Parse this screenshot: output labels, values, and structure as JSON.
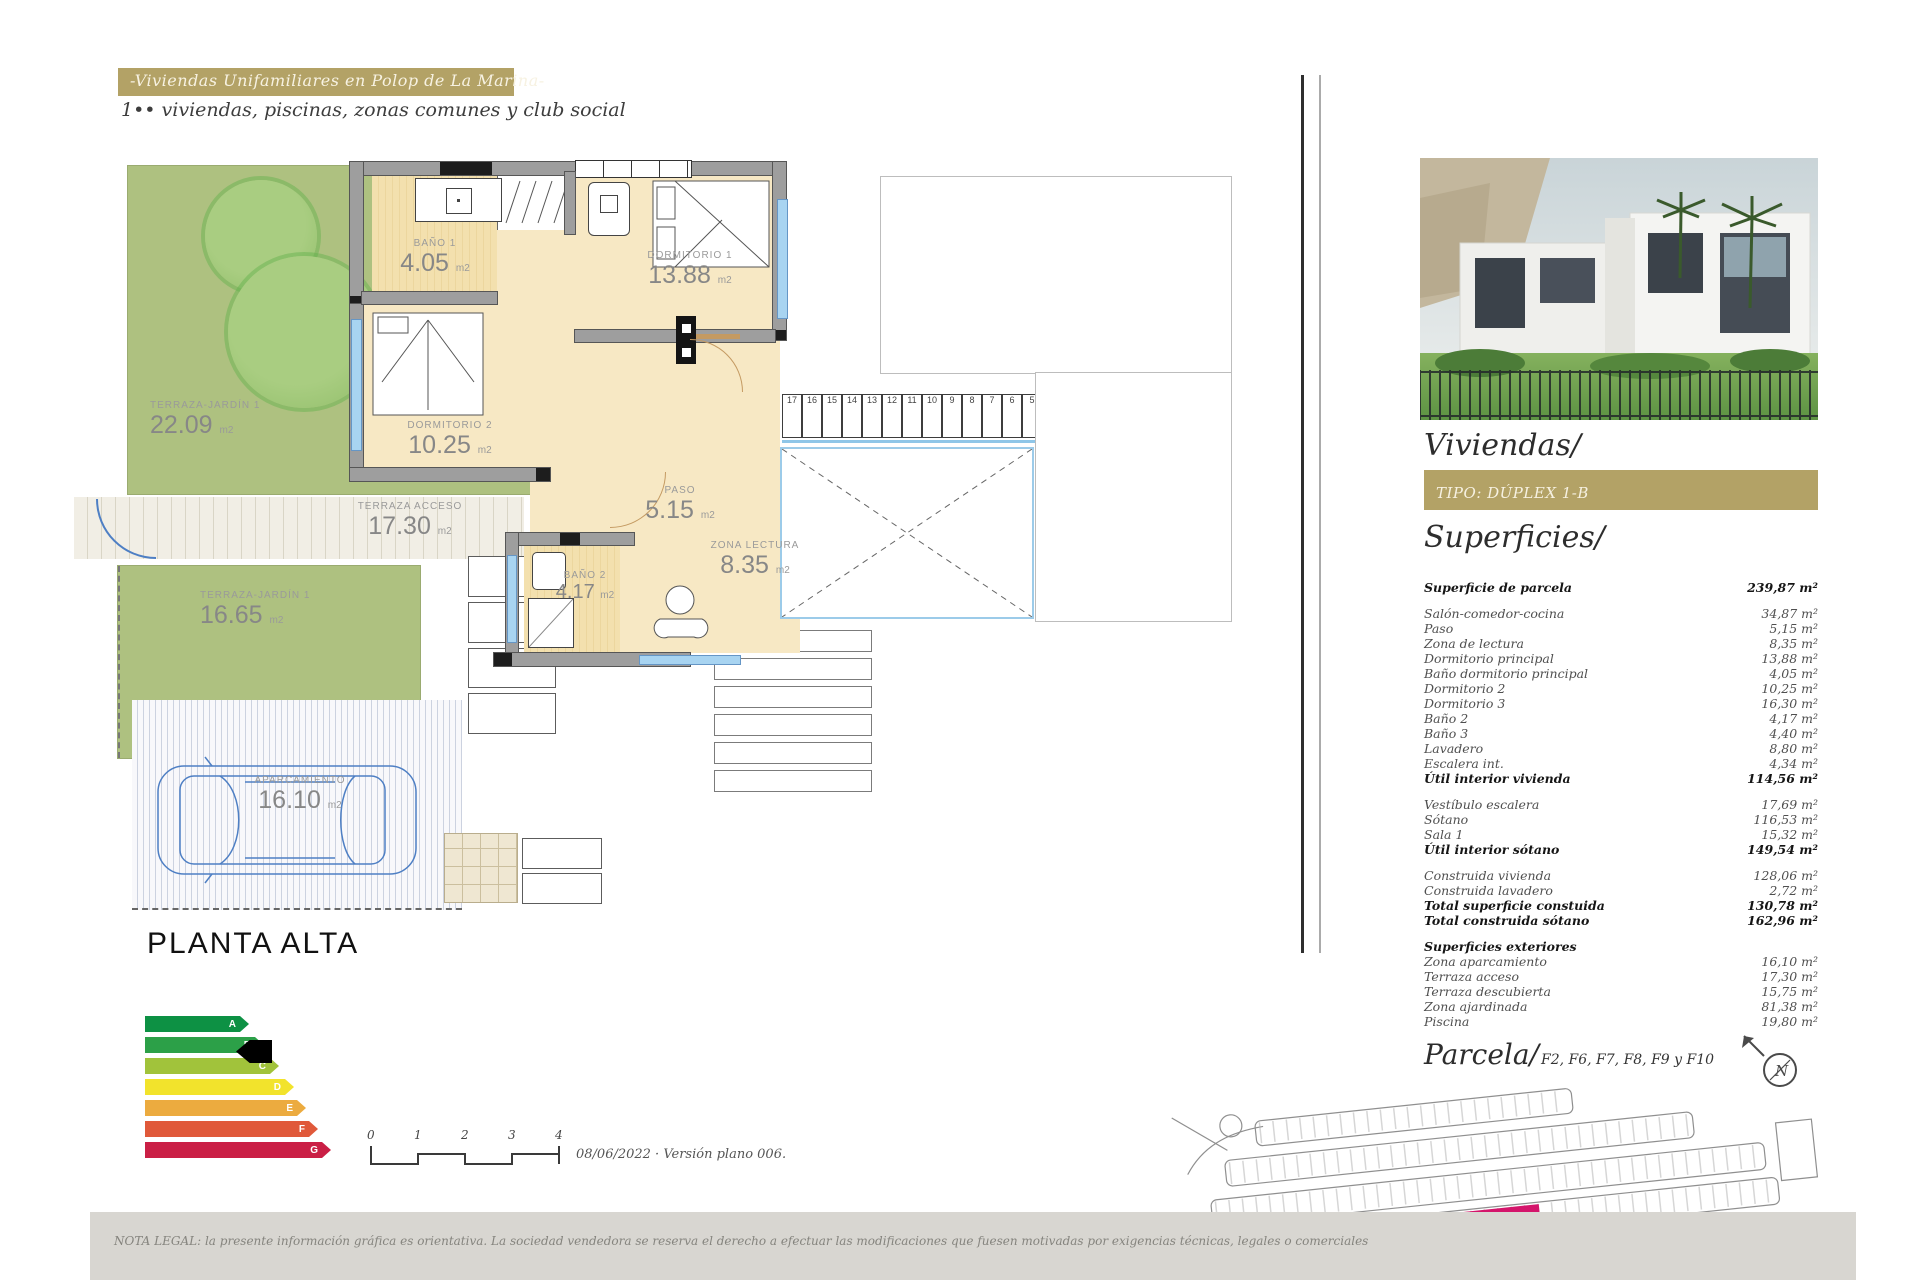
{
  "header": {
    "title": "-Viviendas Unifamiliares en Polop de La Marina-",
    "subtitle": "1•• viviendas, piscinas, zonas comunes y club social"
  },
  "plan": {
    "title": "PLANTA ALTA",
    "rooms": [
      {
        "name": "TERRAZA-JARDÍN 1",
        "area": "22.09",
        "unit": "m2"
      },
      {
        "name": "BAÑO 1",
        "area": "4.05",
        "unit": "m2"
      },
      {
        "name": "DORMITORIO 1",
        "area": "13.88",
        "unit": "m2"
      },
      {
        "name": "DORMITORIO 2",
        "area": "10.25",
        "unit": "m2"
      },
      {
        "name": "TERRAZA ACCESO",
        "area": "17.30",
        "unit": "m2"
      },
      {
        "name": "PASO",
        "area": "5.15",
        "unit": "m2"
      },
      {
        "name": "ZONA LECTURA",
        "area": "8.35",
        "unit": "m2"
      },
      {
        "name": "BAÑO 2",
        "area": "4.17",
        "unit": "m2"
      },
      {
        "name": "TERRAZA-JARDÍN 1",
        "area": "16.65",
        "unit": "m2"
      },
      {
        "name": "APARCAMIENTO",
        "area": "16.10",
        "unit": "m2"
      }
    ],
    "stair_numbers_run": [
      "17",
      "16",
      "15",
      "14",
      "13",
      "12",
      "11",
      "10",
      "9",
      "8",
      "7",
      "6",
      "5",
      "4"
    ],
    "stair_numbers_col": [
      "3",
      "2",
      "1"
    ],
    "scale_ticks": [
      "0",
      "1",
      "2",
      "3",
      "4"
    ],
    "scale_note": "08/06/2022 · Versión plano 006."
  },
  "energy": {
    "ratings": [
      {
        "label": "A",
        "color": "#0d9144"
      },
      {
        "label": "B",
        "color": "#2ca048"
      },
      {
        "label": "C",
        "color": "#a1c33b"
      },
      {
        "label": "D",
        "color": "#f2e32c"
      },
      {
        "label": "E",
        "color": "#ecab3f"
      },
      {
        "label": "F",
        "color": "#e0593a"
      },
      {
        "label": "G",
        "color": "#ca1f45"
      }
    ],
    "indicated_rating": "B"
  },
  "sidebar": {
    "viviendas_title": "Viviendas/",
    "tipo_label": "TIPO: DÚPLEX 1-B",
    "superficies_title": "Superficies/",
    "rows": [
      {
        "label": "Superficie de parcela",
        "value": "239,87 m²",
        "bold": true
      },
      {
        "spacer": true
      },
      {
        "label": "Salón-comedor-cocina",
        "value": "34,87 m²"
      },
      {
        "label": "Paso",
        "value": "5,15 m²"
      },
      {
        "label": "Zona de lectura",
        "value": "8,35 m²"
      },
      {
        "label": "Dormitorio principal",
        "value": "13,88 m²"
      },
      {
        "label": "Baño dormitorio principal",
        "value": "4,05 m²"
      },
      {
        "label": "Dormitorio 2",
        "value": "10,25 m²"
      },
      {
        "label": "Dormitorio 3",
        "value": "16,30 m²"
      },
      {
        "label": "Baño 2",
        "value": "4,17 m²"
      },
      {
        "label": "Baño 3",
        "value": "4,40 m²"
      },
      {
        "label": "Lavadero",
        "value": "8,80 m²"
      },
      {
        "label": "Escalera int.",
        "value": "4,34 m²"
      },
      {
        "label": "Útil interior vivienda",
        "value": "114,56 m²",
        "bold": true
      },
      {
        "spacer": true
      },
      {
        "label": "Vestíbulo escalera",
        "value": "17,69 m²"
      },
      {
        "label": "Sótano",
        "value": "116,53 m²"
      },
      {
        "label": "Sala 1",
        "value": "15,32 m²"
      },
      {
        "label": "Útil interior sótano",
        "value": "149,54 m²",
        "bold": true
      },
      {
        "spacer": true
      },
      {
        "label": "Construida vivienda",
        "value": "128,06 m²"
      },
      {
        "label": "Construida lavadero",
        "value": "2,72 m²"
      },
      {
        "label": "Total superficie constuida",
        "value": "130,78 m²",
        "bold": true
      },
      {
        "label": "Total construida sótano",
        "value": "162,96 m²",
        "bold": true
      },
      {
        "spacer": true
      },
      {
        "label": "Superficies exteriores",
        "value": "",
        "bold": true
      },
      {
        "label": "Zona aparcamiento",
        "value": "16,10 m²"
      },
      {
        "label": "Terraza acceso",
        "value": "17,30 m²"
      },
      {
        "label": "Terraza descubierta",
        "value": "15,75 m²"
      },
      {
        "label": "Zona ajardinada",
        "value": "81,38 m²"
      },
      {
        "label": "Piscina",
        "value": "19,80 m²"
      }
    ],
    "parcela_title": "Parcela/",
    "parcela_subtitle": "F2, F6, F7, F8, F9 y F10",
    "compass_letter": "N"
  },
  "footer": {
    "legal": "NOTA LEGAL: la presente información gráfica es orientativa. La sociedad vendedora se reserva el derecho a efectuar las modificaciones que fuesen motivadas por exigencias técnicas, legales o comerciales"
  },
  "colors": {
    "gold": "#b3a266",
    "floor_beige": "#f7e8c4",
    "wall_gray": "#9e9e9e",
    "garden_green": "#aec180",
    "plan_blue": "#4e7fc4",
    "parcel_highlight": "#d4156b",
    "legal_bar": "#d8d6d1"
  }
}
